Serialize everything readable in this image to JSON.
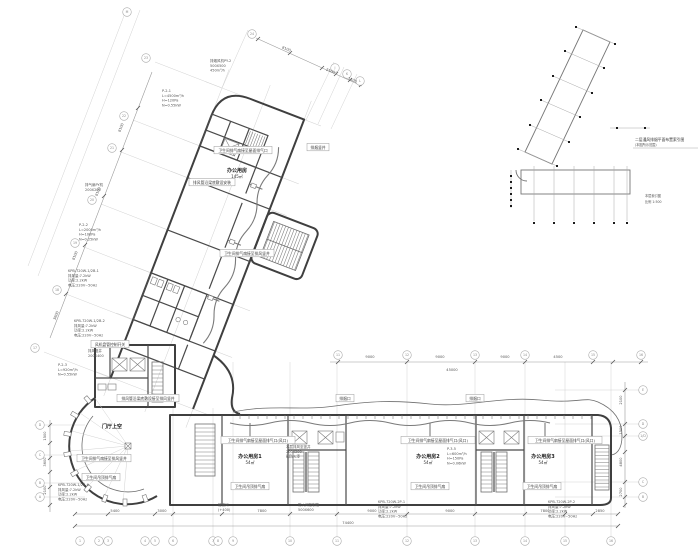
{
  "keyplan": {
    "title": "二层通风排烟平面布置索引图",
    "subtitle": "(本图所示范围)",
    "caption1": "本层索引图",
    "caption2": "比例 1:500"
  },
  "room_labels": [
    {
      "x": 237,
      "y": 172,
      "name": "办公用房",
      "area": "145㎡"
    },
    {
      "x": 112,
      "y": 428,
      "name": "门厅上空",
      "area": ""
    },
    {
      "x": 250,
      "y": 458,
      "name": "办公用房1",
      "area": "54㎡"
    },
    {
      "x": 428,
      "y": 458,
      "name": "办公用房2",
      "area": "54㎡"
    },
    {
      "x": 543,
      "y": 458,
      "name": "办公用房3",
      "area": "54㎡"
    }
  ],
  "boxed_notes": [
    {
      "x": 243,
      "y": 151,
      "text": "卫生间排气扇接至屋面排气口"
    },
    {
      "x": 212,
      "y": 183,
      "text": "排风管沿梁底敷设安装"
    },
    {
      "x": 247,
      "y": 254,
      "text": "卫生间排气扇接至排风竖井"
    },
    {
      "x": 318,
      "y": 148,
      "text": "排烟竖井"
    },
    {
      "x": 110,
      "y": 345,
      "text": "风机盘管控制开关"
    },
    {
      "x": 148,
      "y": 399,
      "text": "排风管沿梁底敷设接至排风竖井"
    },
    {
      "x": 104,
      "y": 459,
      "text": "卫生间排气扇接至排风竖井"
    },
    {
      "x": 101,
      "y": 478,
      "text": "卫生间吊顶排气扇"
    },
    {
      "x": 258,
      "y": 441,
      "text": "卫生间排气扇接至屋面排气口(风口)"
    },
    {
      "x": 438,
      "y": 441,
      "text": "卫生间排气扇接至屋面排气口(风口)"
    },
    {
      "x": 565,
      "y": 441,
      "text": "卫生间排气扇接至屋面排气口(风口)"
    },
    {
      "x": 250,
      "y": 487,
      "text": "卫生间吊顶排气扇"
    },
    {
      "x": 430,
      "y": 487,
      "text": "卫生间吊顶排气扇"
    },
    {
      "x": 542,
      "y": 487,
      "text": "卫生间吊顶排气扇"
    },
    {
      "x": 345,
      "y": 399,
      "text": "排烟口"
    },
    {
      "x": 475,
      "y": 399,
      "text": "排烟口"
    }
  ],
  "leader_stacks": [
    {
      "x": 210,
      "y": 62,
      "lines": [
        "排烟风机PY-2",
        "500X500",
        "450m³/h"
      ]
    },
    {
      "x": 162,
      "y": 92,
      "lines": [
        "P-2-1",
        "L=4500m³/h",
        "H=120Pa",
        "N=0.55kW"
      ]
    },
    {
      "x": 85,
      "y": 186,
      "lines": [
        "排气扇PY机",
        "200X200"
      ]
    },
    {
      "x": 79,
      "y": 226,
      "lines": [
        "P-2-2",
        "L=2000m³/h",
        "H=100Pa",
        "N=0.25kW"
      ]
    },
    {
      "x": 68,
      "y": 272,
      "lines": [
        "KPB-720W-1/2B-1",
        "排风量:7.2kW",
        "功率:2.2kW",
        "电压:220V~50Hz"
      ]
    },
    {
      "x": 74,
      "y": 322,
      "lines": [
        "KPB-720W-1/2B-2",
        "排风量:7.2kW",
        "功率:2.2kW",
        "电压:220V~50Hz"
      ]
    },
    {
      "x": 88,
      "y": 352,
      "lines": [
        "排风竖井",
        "200X400"
      ]
    },
    {
      "x": 58,
      "y": 366,
      "lines": [
        "P-2-3",
        "L=920m³/h",
        "N=0.55kW"
      ]
    },
    {
      "x": 58,
      "y": 486,
      "lines": [
        "KPB-720W-1/2B-6",
        "排风量:7.2kW",
        "功率:2.2kW",
        "电压:220V~50Hz"
      ]
    },
    {
      "x": 447,
      "y": 450,
      "lines": [
        "P-3-5",
        "L=600m³/h",
        "H=150Pa",
        "N=0.06kW"
      ]
    },
    {
      "x": 286,
      "y": 448,
      "lines": [
        "本层排风至竖井",
        "200X200",
        "刷防火漆"
      ]
    },
    {
      "x": 218,
      "y": 506,
      "lines": [
        "管道间",
        "(+400)"
      ]
    },
    {
      "x": 298,
      "y": 506,
      "lines": [
        "防火阀控制箱",
        "500X600"
      ]
    },
    {
      "x": 378,
      "y": 503,
      "lines": [
        "KPB-720W-2P-1",
        "排风量:7.2kW",
        "功率:2.2kW",
        "电压:220V~50Hz"
      ]
    },
    {
      "x": 548,
      "y": 503,
      "lines": [
        "KPB-720W-2P-2",
        "排风量:7.2kW",
        "功率:2.2kW",
        "电压:220V~50Hz"
      ]
    }
  ],
  "dim_texts": [
    {
      "x": 115,
      "y": 512,
      "t": "5400"
    },
    {
      "x": 162,
      "y": 512,
      "t": "3000"
    },
    {
      "x": 262,
      "y": 512,
      "t": "7800"
    },
    {
      "x": 372,
      "y": 512,
      "t": "9000"
    },
    {
      "x": 450,
      "y": 512,
      "t": "9000"
    },
    {
      "x": 545,
      "y": 512,
      "t": "7800"
    },
    {
      "x": 600,
      "y": 512,
      "t": "2850"
    },
    {
      "x": 348,
      "y": 524,
      "t": "74400"
    },
    {
      "x": 370,
      "y": 358,
      "t": "9000"
    },
    {
      "x": 440,
      "y": 358,
      "t": "9000"
    },
    {
      "x": 505,
      "y": 358,
      "t": "9000"
    },
    {
      "x": 558,
      "y": 358,
      "t": "4500"
    },
    {
      "x": 452,
      "y": 371,
      "t": "45000"
    },
    {
      "x": 622,
      "y": 400,
      "t": "2100",
      "r": -90
    },
    {
      "x": 622,
      "y": 430,
      "t": "1500",
      "r": -90
    },
    {
      "x": 622,
      "y": 462,
      "t": "4800",
      "r": -90
    },
    {
      "x": 622,
      "y": 492,
      "t": "2700",
      "r": -90
    },
    {
      "x": 46,
      "y": 436,
      "t": "1500",
      "r": -90
    },
    {
      "x": 46,
      "y": 462,
      "t": "3600",
      "r": -90
    },
    {
      "x": 46,
      "y": 490,
      "t": "2100",
      "r": -90
    },
    {
      "x": 122,
      "y": 128,
      "t": "8100",
      "r": -69
    },
    {
      "x": 99,
      "y": 192,
      "t": "8100",
      "r": -69
    },
    {
      "x": 76,
      "y": 256,
      "t": "8100",
      "r": -69
    },
    {
      "x": 57,
      "y": 316,
      "t": "3600",
      "r": -69
    },
    {
      "x": 286,
      "y": 50,
      "t": "8100",
      "r": 21
    },
    {
      "x": 330,
      "y": 72,
      "t": "2100",
      "r": 21
    },
    {
      "x": 352,
      "y": 81,
      "t": "1500",
      "r": 21
    }
  ],
  "grid_bubbles": [
    {
      "x": 80,
      "y": 541,
      "l": "1"
    },
    {
      "x": 99,
      "y": 541,
      "l": "2"
    },
    {
      "x": 108,
      "y": 541,
      "l": "3"
    },
    {
      "x": 145,
      "y": 541,
      "l": "4"
    },
    {
      "x": 155,
      "y": 541,
      "l": "5"
    },
    {
      "x": 173,
      "y": 541,
      "l": "6"
    },
    {
      "x": 213,
      "y": 541,
      "l": "7"
    },
    {
      "x": 218,
      "y": 541,
      "l": "8"
    },
    {
      "x": 233,
      "y": 541,
      "l": "9"
    },
    {
      "x": 290,
      "y": 541,
      "l": "10"
    },
    {
      "x": 337,
      "y": 541,
      "l": "11"
    },
    {
      "x": 407,
      "y": 541,
      "l": "12"
    },
    {
      "x": 475,
      "y": 541,
      "l": "13"
    },
    {
      "x": 525,
      "y": 541,
      "l": "14"
    },
    {
      "x": 565,
      "y": 541,
      "l": "15"
    },
    {
      "x": 611,
      "y": 541,
      "l": "16"
    },
    {
      "x": 338,
      "y": 355,
      "l": "11"
    },
    {
      "x": 407,
      "y": 355,
      "l": "12"
    },
    {
      "x": 475,
      "y": 355,
      "l": "13"
    },
    {
      "x": 525,
      "y": 355,
      "l": "14"
    },
    {
      "x": 593,
      "y": 355,
      "l": "15"
    },
    {
      "x": 641,
      "y": 355,
      "l": "16"
    },
    {
      "x": 643,
      "y": 390,
      "l": "E"
    },
    {
      "x": 643,
      "y": 424,
      "l": "D"
    },
    {
      "x": 643,
      "y": 436,
      "l": "1/D"
    },
    {
      "x": 643,
      "y": 482,
      "l": "C"
    },
    {
      "x": 643,
      "y": 497,
      "l": "B"
    },
    {
      "x": 40,
      "y": 425,
      "l": "D"
    },
    {
      "x": 40,
      "y": 455,
      "l": "C"
    },
    {
      "x": 40,
      "y": 483,
      "l": "B"
    },
    {
      "x": 40,
      "y": 497,
      "l": "A"
    },
    {
      "x": 35,
      "y": 348,
      "l": "17"
    },
    {
      "x": 57,
      "y": 290,
      "l": "18"
    },
    {
      "x": 75,
      "y": 243,
      "l": "19"
    },
    {
      "x": 92,
      "y": 200,
      "l": "20"
    },
    {
      "x": 112,
      "y": 148,
      "l": "21"
    },
    {
      "x": 124,
      "y": 116,
      "l": "22"
    },
    {
      "x": 146,
      "y": 58,
      "l": "23"
    },
    {
      "x": 252,
      "y": 34,
      "l": "24"
    },
    {
      "x": 335,
      "y": 68,
      "l": "J"
    },
    {
      "x": 347,
      "y": 74,
      "l": "K"
    },
    {
      "x": 360,
      "y": 81,
      "l": "L"
    },
    {
      "x": 127,
      "y": 12,
      "l": "M"
    }
  ]
}
